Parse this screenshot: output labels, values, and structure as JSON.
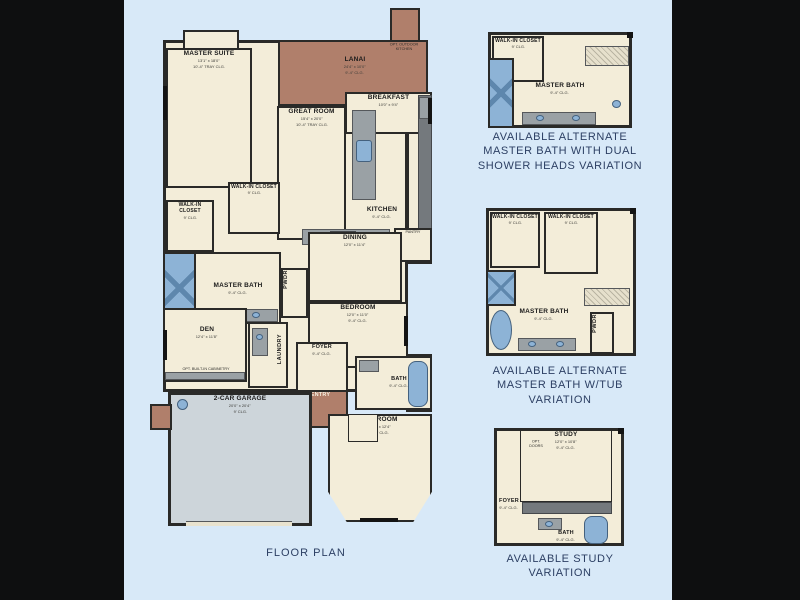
{
  "palette": {
    "page_bg": "#0e0f10",
    "canvas_bg": "#d8e9f8",
    "wall": "#2a2a28",
    "room_fill": "#f3edd9",
    "lanai_fill": "#b07f6b",
    "garage_fill": "#cdd5da",
    "fixture_blue": "#8db3d6",
    "fixture_blue_dark": "#5e87ad",
    "counter_gray": "#9aa1a5",
    "counter_dark": "#74797d",
    "caption_color": "#2c3f63",
    "label_color": "#1b1b1b"
  },
  "main_plan": {
    "caption": "FLOOR PLAN",
    "rooms": {
      "master_suite": {
        "label": "MASTER SUITE",
        "dims": "13'1\" x 18'0\"",
        "note": "10'-4\" TRAY CLG."
      },
      "lanai": {
        "label": "LANAI",
        "dims": "24'4\" x 10'0\"",
        "note": "9'-4\" CLG."
      },
      "breakfast": {
        "label": "BREAKFAST",
        "dims": "10'0\" x 9'4\""
      },
      "great_room": {
        "label": "GREAT ROOM",
        "dims": "15'4\" x 20'0\"",
        "note": "10'-4\" TRAY CLG."
      },
      "kitchen": {
        "label": "KITCHEN",
        "dims": "9'-4\" CLG."
      },
      "pantry": {
        "label": "PANTRY"
      },
      "walkin_closet_1": {
        "label": "WALK-IN CLOSET",
        "dims": "9' CLG."
      },
      "walkin_closet_2": {
        "label": "WALK-IN CLOSET",
        "dims": "9' CLG."
      },
      "master_bath": {
        "label": "MASTER BATH",
        "dims": "9'-4\" CLG."
      },
      "pwdr": {
        "label": "PWDR"
      },
      "dining": {
        "label": "DINING",
        "dims": "12'0\" x 11'4\""
      },
      "bedroom_1": {
        "label": "BEDROOM",
        "dims": "12'0\" x 11'0\"",
        "note": "9'-4\" CLG."
      },
      "den": {
        "label": "DEN",
        "dims": "12'4\" x 11'8\"",
        "note": "9'-4\" CLG."
      },
      "laundry": {
        "label": "LAUNDRY"
      },
      "foyer": {
        "label": "FOYER",
        "dims": "9'-4\" CLG."
      },
      "entry": {
        "label": "ENTRY"
      },
      "bath": {
        "label": "BATH",
        "dims": "9'-4\" CLG."
      },
      "garage": {
        "label": "2-CAR GARAGE",
        "dims": "20'0\" x 20'4\"",
        "note": "9' CLG."
      },
      "bedroom_2": {
        "label": "BEDROOM",
        "dims": "12'0\" x 12'4\"",
        "note": "9'-4\" CLG."
      }
    },
    "annotations": {
      "opt_outdoor_kitchen": "OPT. OUTDOOR KITCHEN",
      "opt_den": "OPT. BUILT-IN CABINETRY"
    }
  },
  "variations": [
    {
      "id": "dual-shower",
      "rooms": {
        "walkin_closet": {
          "label": "WALK-IN CLOSET",
          "dims": "9' CLG."
        },
        "master_bath": {
          "label": "MASTER BATH",
          "dims": "9'-4\" CLG."
        }
      },
      "caption_lines": [
        "AVAILABLE ALTERNATE",
        "MASTER BATH WITH DUAL",
        "SHOWER HEADS VARIATION"
      ]
    },
    {
      "id": "tub",
      "rooms": {
        "walkin_closet_1": {
          "label": "WALK-IN CLOSET",
          "dims": "9' CLG."
        },
        "walkin_closet_2": {
          "label": "WALK-IN CLOSET",
          "dims": "9' CLG."
        },
        "master_bath": {
          "label": "MASTER BATH",
          "dims": "9'-4\" CLG."
        },
        "pwdr": {
          "label": "PWDR"
        }
      },
      "caption_lines": [
        "AVAILABLE ALTERNATE",
        "MASTER BATH W/TUB",
        "VARIATION"
      ]
    },
    {
      "id": "study",
      "rooms": {
        "study": {
          "label": "STUDY",
          "dims": "12'0\" x 10'8\"",
          "note": "9'-4\" CLG."
        },
        "foyer": {
          "label": "FOYER",
          "dims": "9'-4\" CLG."
        },
        "bath": {
          "label": "BATH",
          "dims": "9'-4\" CLG."
        }
      },
      "annotations": {
        "opt_doors": "OPT. DOORS"
      },
      "caption_lines": [
        "AVAILABLE STUDY",
        "VARIATION"
      ]
    }
  ]
}
